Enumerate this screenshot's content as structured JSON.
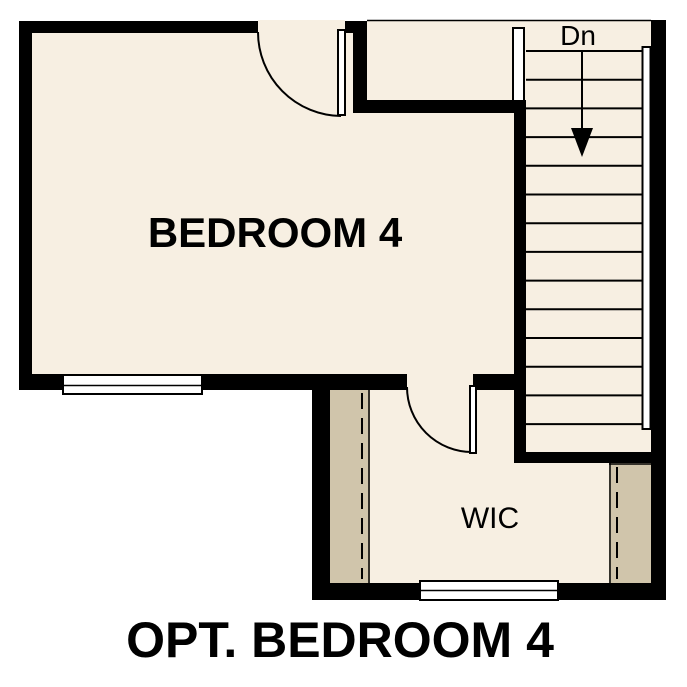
{
  "title": "OPT. BEDROOM 4",
  "rooms": {
    "bedroom": {
      "label": "BEDROOM 4"
    },
    "wic": {
      "label": "WIC"
    }
  },
  "stairs": {
    "direction_label": "Dn",
    "tread_count": 14,
    "tread_y_start": 51,
    "tread_y_step": 28.7,
    "tread_x1": 526,
    "tread_x2": 644
  },
  "colors": {
    "floor": "#f7efe2",
    "closet_shelf": "#d0c5ab",
    "wall": "#000000",
    "outside": "#ffffff"
  }
}
